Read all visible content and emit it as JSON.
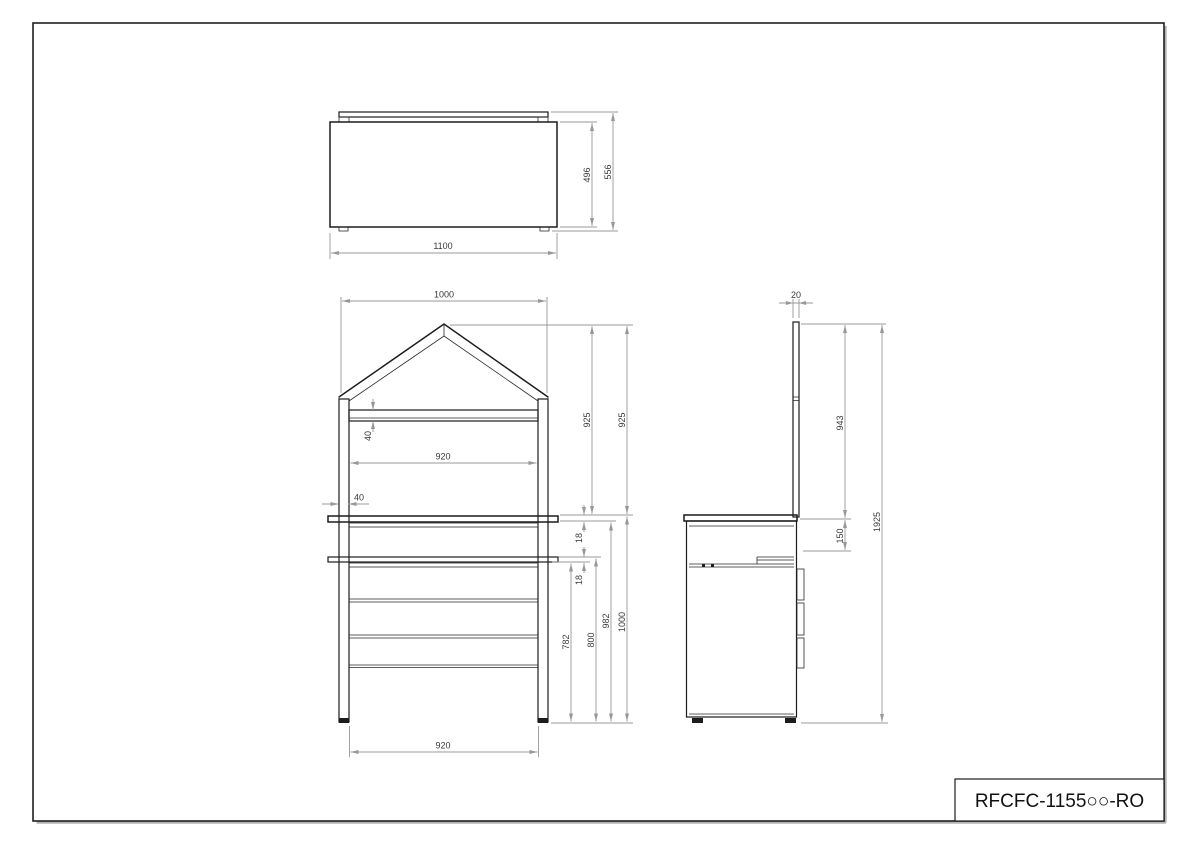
{
  "sheet": {
    "title_code": "RFCFC-1155○○-RO"
  },
  "views": {
    "top_view": {
      "dims": {
        "overall_width": "1100",
        "body_depth": "496",
        "overall_depth": "556"
      }
    },
    "front_view": {
      "dims": {
        "frame_width": "1000",
        "roof_inner_width": "920",
        "roof_shelf_height": "40",
        "post_width": "40",
        "upper_height_left": "925",
        "upper_height_right": "925",
        "worktop_thickness": "18",
        "rail_thickness": "18",
        "height_to_rail_bottom": "782",
        "height_to_rail_top": "800",
        "height_under_worktop": "982",
        "cabinet_height": "1000",
        "base_inner_width": "920"
      }
    },
    "side_view": {
      "dims": {
        "panel_thickness": "20",
        "panel_height_above_top": "943",
        "rail_drop": "150",
        "overall_height": "1925"
      }
    }
  }
}
